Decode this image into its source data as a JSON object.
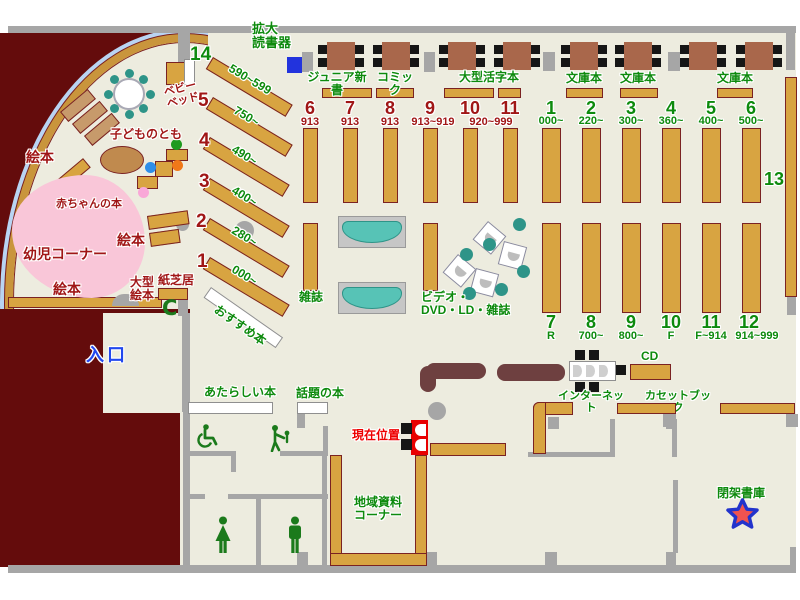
{
  "children": {
    "youji_corner": "幼児コーナー",
    "ehon": "絵本",
    "akachan_book": "赤ちゃんの本",
    "kodomo_no_tomo": "子どものとも",
    "baby_bed": "ベビー\nベッド",
    "ogata_ehon": "大型\n絵本",
    "kamishibai": "紙芝居",
    "phone_mark": "C"
  },
  "entrance_label": "入口",
  "recommend_label": "おすすめ本",
  "current_position_label": "現在位置",
  "diagonal": {
    "numbers": [
      "14",
      "5",
      "4",
      "3",
      "2",
      "1"
    ],
    "ranges": [
      "590~599",
      "750~",
      "490~",
      "400~",
      "280~",
      "000~"
    ]
  },
  "top_row": {
    "magnifier": "拡大\n読書器",
    "junior_shinsho": "ジュニア新書",
    "comic": "コミック",
    "large_print": "大型活字本",
    "bunkobon": "文庫本"
  },
  "mid": {
    "numbers": [
      "6",
      "7",
      "8",
      "9",
      "10",
      "11"
    ],
    "ranges": [
      "913",
      "913",
      "913",
      "913~919",
      "920~999"
    ]
  },
  "right_top": {
    "numbers": [
      "1",
      "2",
      "3",
      "4",
      "5",
      "6"
    ],
    "ranges": [
      "000~",
      "220~",
      "300~",
      "360~",
      "400~",
      "500~"
    ]
  },
  "right_bottom": {
    "numbers": [
      "7",
      "8",
      "9",
      "10",
      "11",
      "12"
    ],
    "ranges": [
      "R",
      "700~",
      "800~",
      "F",
      "F~914",
      "914~999"
    ]
  },
  "shelf13": "13",
  "center_labels": {
    "magazine": "雑誌",
    "av": "ビデオ・\nDVD・LD・雑誌",
    "internet": "インターネット",
    "cd": "CD",
    "cassette": "カセットブック",
    "regional": "地域資料\nコーナー",
    "closed_stack": "閉架書庫",
    "new_books": "あたらしい本",
    "topic_books": "話題の本"
  },
  "colors": {
    "floor": "#edecdf",
    "wall_dark": "#640c0c",
    "shelf": "#d8a441",
    "green_text": "#0d8a0d",
    "darkred_text": "#a01616",
    "marker_red": "#e80000"
  }
}
